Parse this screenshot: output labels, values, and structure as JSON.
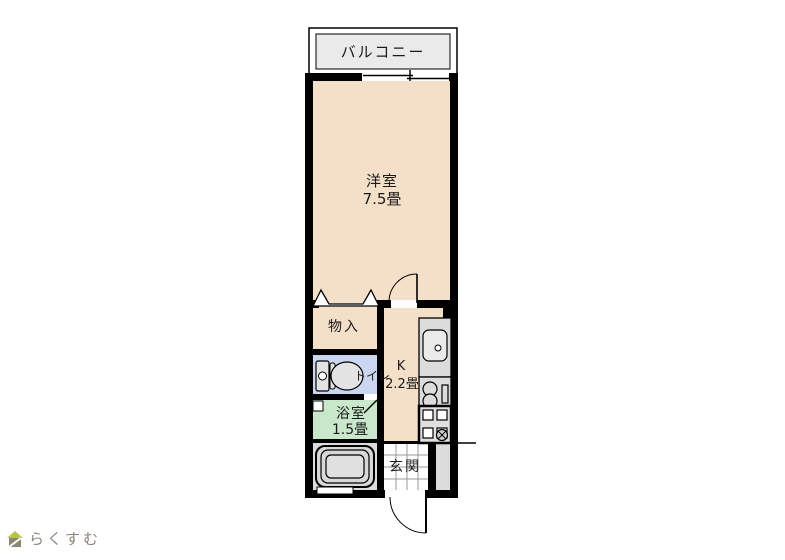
{
  "plan": {
    "balcony": {
      "label": "バルコニー"
    },
    "main_room": {
      "label": "洋室",
      "size": "7.5畳"
    },
    "storage": {
      "label": "物入"
    },
    "toilet": {
      "label": "トイレ"
    },
    "kitchen": {
      "label": "K",
      "size": "2.2畳"
    },
    "bathroom": {
      "label": "浴室",
      "size": "1.5畳"
    },
    "entrance": {
      "label": "玄関"
    }
  },
  "branding": {
    "logo_text": "らくすむ"
  },
  "colors": {
    "wall": "#000000",
    "room_floor": "#f4dfc9",
    "toilet_floor": "#cbd6f0",
    "bath_floor": "#c9e7ca",
    "balcony_floor": "#eaeaea",
    "gray_area": "#dcdcdc",
    "fixture_gray": "#e3e3e3",
    "tile_line": "#9a9a9a",
    "background": "#ffffff",
    "logo_green": "#b5c83c",
    "logo_gray": "#8d857c"
  }
}
